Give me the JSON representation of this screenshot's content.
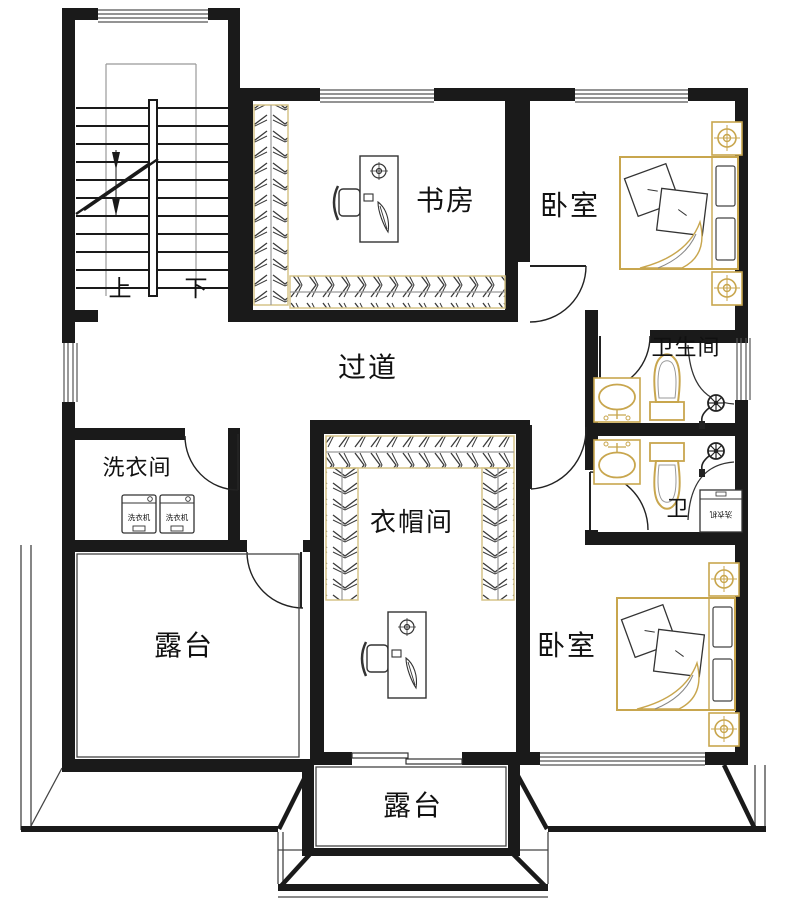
{
  "colors": {
    "wall": "#1a1a1a",
    "thin_line": "#555555",
    "furniture_accent": "#c8a64e",
    "wardrobe_outline": "#d6c488",
    "hatch": "#3a3a3a"
  },
  "rooms": {
    "study": {
      "label": "书房"
    },
    "bedroom_top": {
      "label": "卧室"
    },
    "bedroom_bottom": {
      "label": "卧室"
    },
    "bathroom": {
      "label": "卫生间"
    },
    "toilet": {
      "label": "卫"
    },
    "corridor": {
      "label": "过道"
    },
    "laundry": {
      "label": "洗衣间"
    },
    "cloakroom": {
      "label": "衣帽间"
    },
    "terrace_left": {
      "label": "露台"
    },
    "terrace_bottom": {
      "label": "露台"
    }
  },
  "stairs": {
    "up": "上",
    "down": "下"
  },
  "appliances": {
    "washer": "洗衣机"
  }
}
